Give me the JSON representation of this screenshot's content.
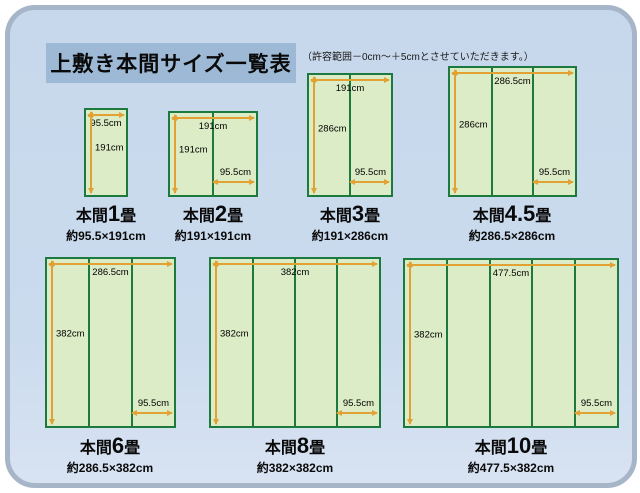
{
  "title": "上敷き本間サイズ一覧表",
  "note": "（許容範囲－0cm～＋5cmとさせていただきます。）",
  "colors": {
    "frame_fill": "#cbdbee",
    "frame_ring": "#a6b5c7",
    "banner_fill": "#9db9d5",
    "mat_fill": "#dcecc6",
    "mat_border": "#1c7a3e",
    "arrow": "#e2a233"
  },
  "diagrams": [
    {
      "id": "1jo",
      "name_prefix": "本間",
      "name_num": "1",
      "name_suffix": "畳",
      "size": "約95.5×191cm",
      "top_label": "95.5cm",
      "left_label": "191cm",
      "columns": 1
    },
    {
      "id": "2jo",
      "name_prefix": "本間",
      "name_num": "2",
      "name_suffix": "畳",
      "size": "約191×191cm",
      "top_label": "191cm",
      "left_label": "191cm",
      "bottom_label": "95.5cm",
      "columns": 2
    },
    {
      "id": "3jo",
      "name_prefix": "本間",
      "name_num": "3",
      "name_suffix": "畳",
      "size": "約191×286cm",
      "top_label": "191cm",
      "left_label": "286cm",
      "bottom_label": "95.5cm",
      "columns": 2
    },
    {
      "id": "4_5jo",
      "name_prefix": "本間",
      "name_num": "4.5",
      "name_suffix": "畳",
      "size": "約286.5×286cm",
      "top_label": "286.5cm",
      "left_label": "286cm",
      "bottom_label": "95.5cm",
      "columns": 3
    },
    {
      "id": "6jo",
      "name_prefix": "本間",
      "name_num": "6",
      "name_suffix": "畳",
      "size": "約286.5×382cm",
      "top_label": "286.5cm",
      "left_label": "382cm",
      "bottom_label": "95.5cm",
      "columns": 3
    },
    {
      "id": "8jo",
      "name_prefix": "本間",
      "name_num": "8",
      "name_suffix": "畳",
      "size": "約382×382cm",
      "top_label": "382cm",
      "left_label": "382cm",
      "bottom_label": "95.5cm",
      "columns": 4
    },
    {
      "id": "10jo",
      "name_prefix": "本間",
      "name_num": "10",
      "name_suffix": "畳",
      "size": "約477.5×382cm",
      "top_label": "477.5cm",
      "left_label": "382cm",
      "bottom_label": "95.5cm",
      "columns": 5
    }
  ]
}
